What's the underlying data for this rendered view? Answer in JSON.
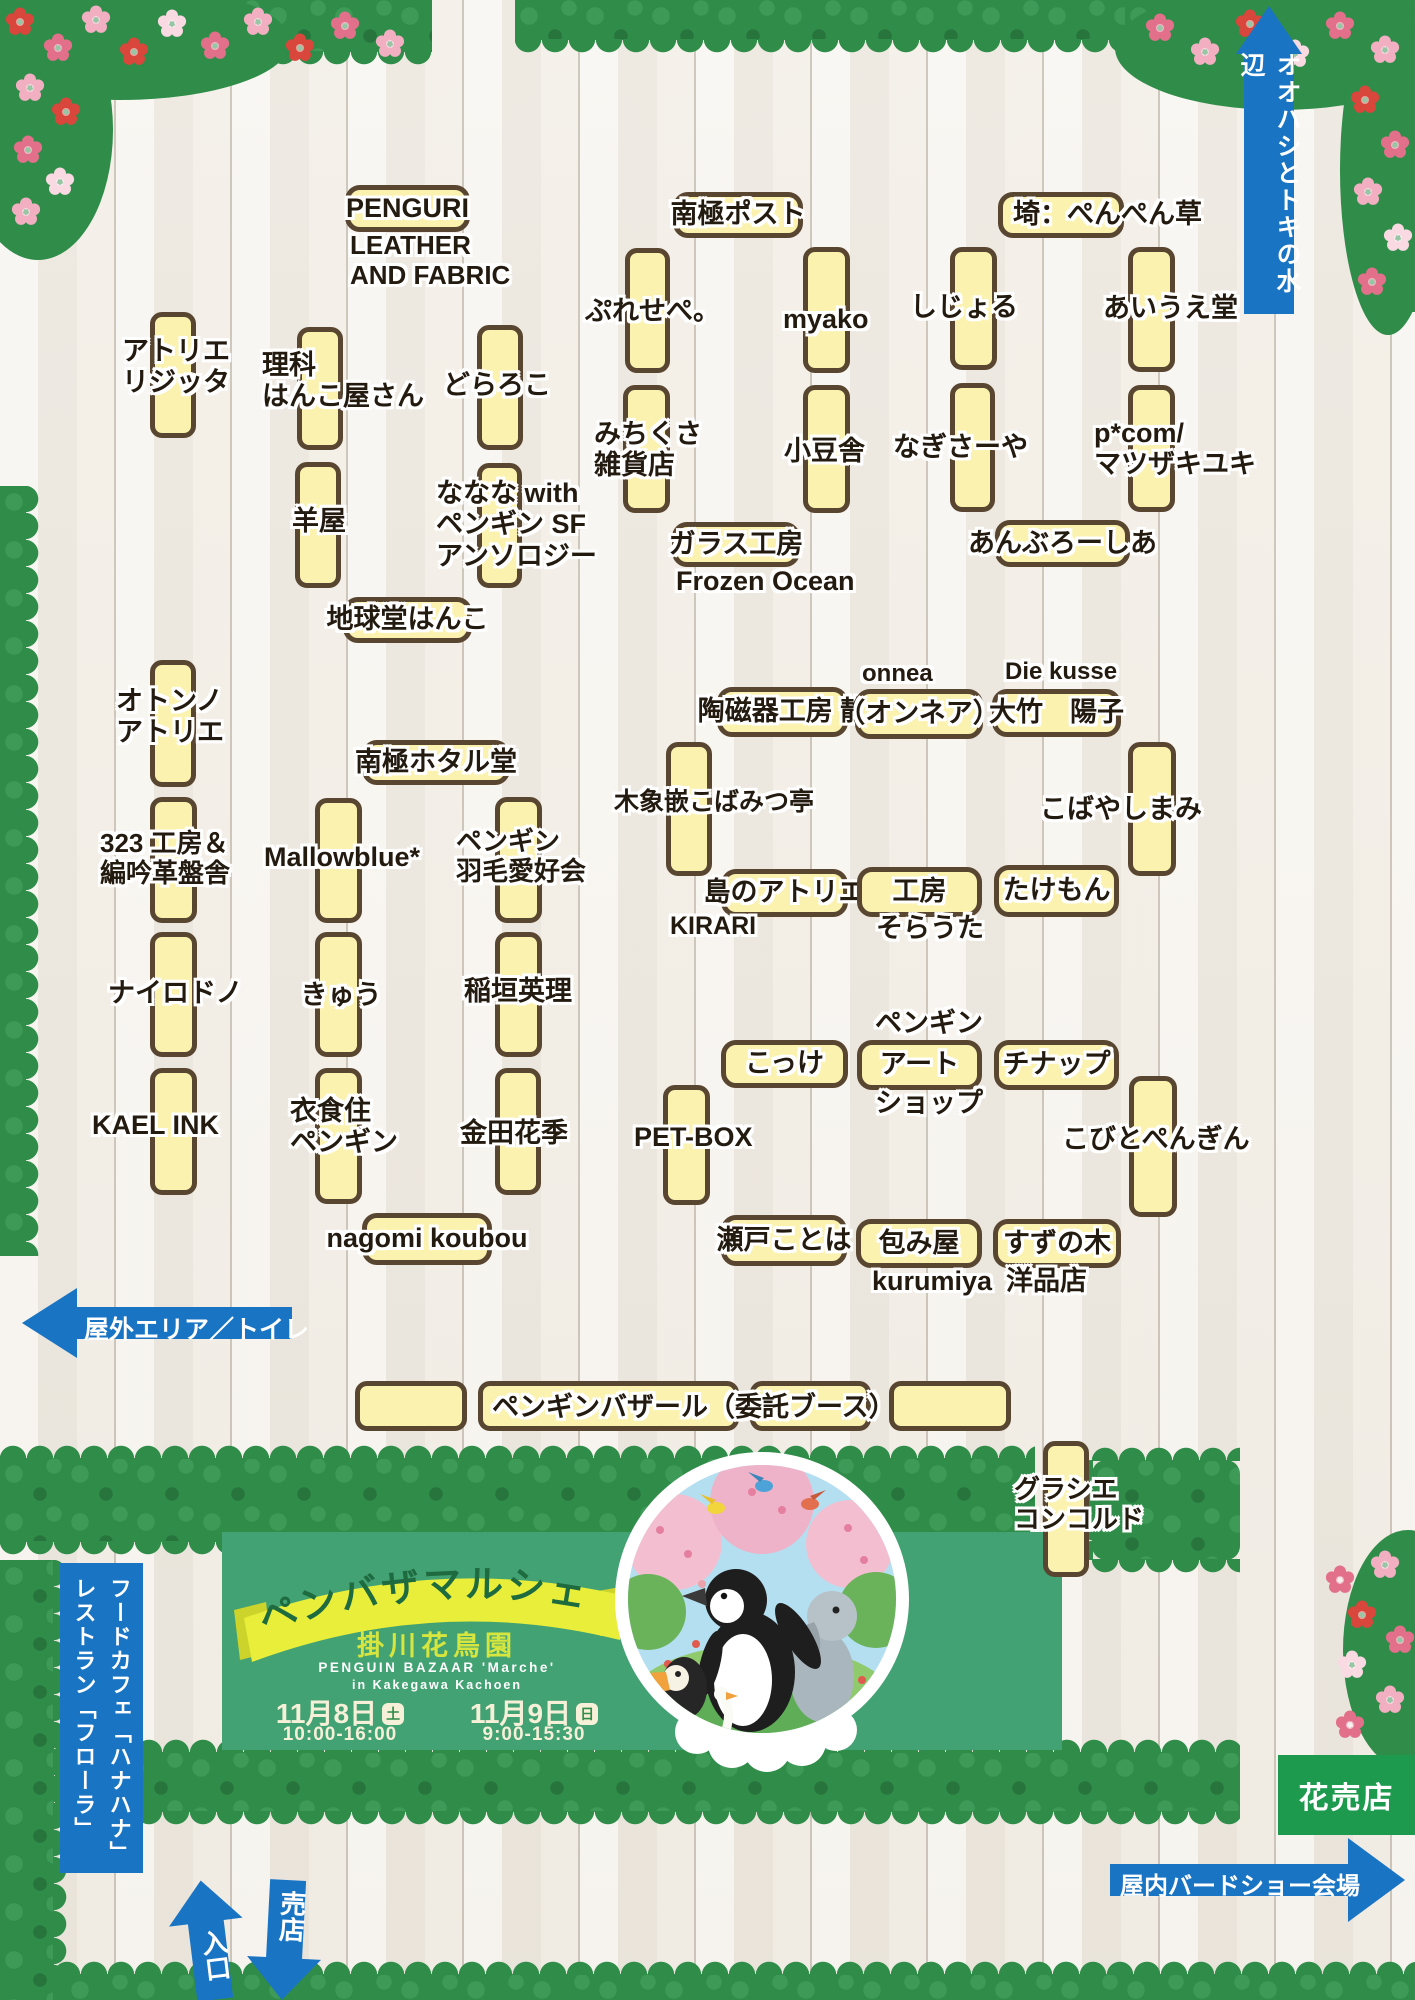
{
  "arrows": {
    "top_right": "オオハシとトキの水辺",
    "outdoor": "屋外エリア／トイレ",
    "indoor_birdshow": "屋内バードショー会場",
    "entrance": "入口",
    "shop": "売店"
  },
  "signs": {
    "restaurant_line1": "レストラン「フローラ」",
    "restaurant_line2": "フードカフェ「ハナハナ」",
    "flower_shop": "花売店"
  },
  "banner": {
    "title": "ペンバザマルシェ",
    "venue": "掛川花鳥園",
    "sub1": "PENGUIN BAZAAR 'Marche'",
    "sub2": "in Kakegawa Kachoen",
    "date1": "11月8日",
    "day1": "土",
    "time1": "10:00-16:00",
    "date2": "11月9日",
    "day2": "日",
    "time2": "9:00-15:30"
  },
  "colors": {
    "booth_fill": "#FAF2AE",
    "booth_border": "#594631",
    "signage_blue": "#1A74C4",
    "banner_green": "#43A273",
    "hedge_green": "#2F8C49",
    "ribbon_yellow": "#E9EE3A",
    "ribbon_text_green": "#1E6B40",
    "flower_shop_green": "#1D9A4E"
  },
  "booths": [
    [
      150,
      312,
      46,
      126
    ],
    [
      297,
      327,
      46,
      123
    ],
    [
      295,
      462,
      46,
      126
    ],
    [
      477,
      325,
      46,
      125
    ],
    [
      477,
      463,
      45,
      125
    ],
    [
      625,
      248,
      45,
      125
    ],
    [
      623,
      385,
      47,
      128
    ],
    [
      803,
      247,
      47,
      126
    ],
    [
      803,
      385,
      47,
      128
    ],
    [
      950,
      247,
      47,
      123
    ],
    [
      950,
      383,
      45,
      129
    ],
    [
      1128,
      247,
      47,
      125
    ],
    [
      1128,
      385,
      47,
      127
    ],
    [
      150,
      660,
      46,
      127
    ],
    [
      150,
      797,
      47,
      126
    ],
    [
      150,
      932,
      47,
      125
    ],
    [
      150,
      1068,
      47,
      127
    ],
    [
      315,
      798,
      47,
      125
    ],
    [
      315,
      932,
      47,
      125
    ],
    [
      315,
      1068,
      47,
      136
    ],
    [
      495,
      797,
      47,
      126
    ],
    [
      495,
      932,
      47,
      125
    ],
    [
      495,
      1068,
      46,
      127
    ],
    [
      666,
      742,
      46,
      134
    ],
    [
      1128,
      742,
      48,
      134
    ],
    [
      663,
      1085,
      47,
      120
    ],
    [
      1129,
      1076,
      48,
      141
    ],
    [
      1043,
      1441,
      46,
      136
    ],
    [
      355,
      1381,
      112,
      50
    ],
    [
      478,
      1381,
      261,
      50
    ],
    [
      750,
      1381,
      121,
      50
    ],
    [
      889,
      1381,
      122,
      50
    ]
  ],
  "pills": [
    {
      "t": "PENGURI",
      "x": 345,
      "y": 185,
      "w": 125,
      "h": 47
    },
    {
      "t": "南極ポスト",
      "x": 673,
      "y": 192,
      "w": 130,
      "h": 46
    },
    {
      "t": "埼：ぺんぺん草",
      "x": 998,
      "y": 192,
      "w": 126,
      "h": 46,
      "al": true
    },
    {
      "t": "ガラス工房",
      "x": 672,
      "y": 522,
      "w": 128,
      "h": 45
    },
    {
      "t": "あんぶろーしあ",
      "x": 995,
      "y": 520,
      "w": 135,
      "h": 47
    },
    {
      "t": "地球堂はんこ",
      "x": 343,
      "y": 597,
      "w": 129,
      "h": 46
    },
    {
      "t": "南極ホタル堂",
      "x": 362,
      "y": 740,
      "w": 148,
      "h": 45
    },
    {
      "t": "陶磁器工房 静",
      "x": 717,
      "y": 687,
      "w": 131,
      "h": 50
    },
    {
      "t": "（オンネア）",
      "x": 855,
      "y": 689,
      "w": 128,
      "h": 50
    },
    {
      "t": "大竹　陽子",
      "x": 992,
      "y": 689,
      "w": 129,
      "h": 48
    },
    {
      "t": "島のアトリエ",
      "x": 721,
      "y": 869,
      "w": 127,
      "h": 48
    },
    {
      "t": "工房",
      "x": 857,
      "y": 867,
      "w": 125,
      "h": 50
    },
    {
      "t": "たけもん",
      "x": 994,
      "y": 865,
      "w": 125,
      "h": 52
    },
    {
      "t": "こっけ",
      "x": 721,
      "y": 1040,
      "w": 127,
      "h": 48
    },
    {
      "t": "アート",
      "x": 857,
      "y": 1040,
      "w": 125,
      "h": 50
    },
    {
      "t": "チナップ",
      "x": 994,
      "y": 1040,
      "w": 125,
      "h": 50
    },
    {
      "t": "nagomi koubou",
      "x": 362,
      "y": 1213,
      "w": 130,
      "h": 52
    },
    {
      "t": "瀬戸ことは",
      "x": 721,
      "y": 1215,
      "w": 126,
      "h": 51
    },
    {
      "t": "包み屋",
      "x": 856,
      "y": 1219,
      "w": 126,
      "h": 49
    },
    {
      "t": "すずの木",
      "x": 993,
      "y": 1219,
      "w": 128,
      "h": 49
    }
  ],
  "labels": [
    {
      "t": "LEATHER\nAND FABRIC",
      "x": 350,
      "y": 230,
      "w": 170,
      "s": 26,
      "a": "left"
    },
    {
      "t": "アトリエ\nリジッタ",
      "x": 122,
      "y": 336,
      "w": 118,
      "s": 27,
      "a": "left"
    },
    {
      "t": "理科\nはんこ屋さん",
      "x": 262,
      "y": 350,
      "w": 180,
      "s": 27,
      "a": "left"
    },
    {
      "t": "どらろこ",
      "x": 443,
      "y": 370,
      "s": 27,
      "a": "left",
      "nw": true
    },
    {
      "t": "羊屋",
      "x": 288,
      "y": 506,
      "w": 62,
      "s": 27
    },
    {
      "t": "ななな with\nペンギン SF\nアンソロジー",
      "x": 436,
      "y": 478,
      "w": 175,
      "s": 27,
      "a": "left"
    },
    {
      "t": "ぷれせぺ。",
      "x": 585,
      "y": 296,
      "s": 27,
      "a": "left",
      "nw": true
    },
    {
      "t": "myako",
      "x": 783,
      "y": 304,
      "s": 27,
      "a": "left",
      "nw": true
    },
    {
      "t": "しじょる",
      "x": 910,
      "y": 292,
      "s": 27,
      "a": "left",
      "nw": true
    },
    {
      "t": "あいうえ堂",
      "x": 1103,
      "y": 293,
      "s": 27,
      "a": "left",
      "nw": true
    },
    {
      "t": "みちくさ\n雑貨店",
      "x": 594,
      "y": 419,
      "w": 112,
      "s": 27,
      "a": "left"
    },
    {
      "t": "小豆舎",
      "x": 784,
      "y": 436,
      "s": 27,
      "a": "left",
      "nw": true
    },
    {
      "t": "なぎさーや",
      "x": 893,
      "y": 432,
      "s": 27,
      "a": "left",
      "nw": true
    },
    {
      "t": "p*com/\nマツザキユキ",
      "x": 1094,
      "y": 418,
      "w": 170,
      "s": 27,
      "a": "left"
    },
    {
      "t": "Frozen Ocean",
      "x": 676,
      "y": 566,
      "s": 27,
      "a": "left",
      "nw": true
    },
    {
      "t": "木象嵌こばみつ亭",
      "x": 614,
      "y": 788,
      "s": 25,
      "a": "left",
      "nw": true
    },
    {
      "t": "こばやしまみ",
      "x": 1040,
      "y": 794,
      "s": 27,
      "a": "left",
      "nw": true
    },
    {
      "t": "onnea",
      "x": 862,
      "y": 660,
      "s": 24,
      "a": "left",
      "nw": true
    },
    {
      "t": "Die kusse",
      "x": 1005,
      "y": 658,
      "s": 24,
      "a": "left",
      "nw": true
    },
    {
      "t": "KIRARI",
      "x": 670,
      "y": 912,
      "s": 25,
      "a": "left",
      "nw": true
    },
    {
      "t": "そらうた",
      "x": 876,
      "y": 913,
      "w": 108,
      "s": 27
    },
    {
      "t": "ペンギン",
      "x": 874,
      "y": 1008,
      "w": 110,
      "s": 27
    },
    {
      "t": "ショップ",
      "x": 874,
      "y": 1088,
      "w": 110,
      "s": 27
    },
    {
      "t": "kurumiya",
      "x": 872,
      "y": 1266,
      "s": 27,
      "a": "left",
      "nw": true
    },
    {
      "t": "洋品店",
      "x": 1006,
      "y": 1266,
      "s": 27,
      "a": "left",
      "nw": true
    },
    {
      "t": "オトンノ\nアトリエ",
      "x": 116,
      "y": 686,
      "w": 118,
      "s": 27,
      "a": "left"
    },
    {
      "t": "323 工房＆\n編吟革盤舎",
      "x": 100,
      "y": 828,
      "w": 150,
      "s": 26,
      "a": "left"
    },
    {
      "t": "ナイロドノ",
      "x": 108,
      "y": 978,
      "s": 27,
      "a": "left",
      "nw": true
    },
    {
      "t": "KAEL INK",
      "x": 92,
      "y": 1110,
      "s": 27,
      "a": "left",
      "nw": true
    },
    {
      "t": "Mallowblue*",
      "x": 264,
      "y": 842,
      "s": 27,
      "a": "left",
      "nw": true
    },
    {
      "t": "きゅう",
      "x": 298,
      "y": 980,
      "w": 86,
      "s": 27
    },
    {
      "t": "衣食住\nペンギン",
      "x": 290,
      "y": 1096,
      "w": 120,
      "s": 27,
      "a": "left"
    },
    {
      "t": "ペンギン\n羽毛愛好会",
      "x": 456,
      "y": 826,
      "w": 142,
      "s": 26,
      "a": "left"
    },
    {
      "t": "稲垣英理",
      "x": 464,
      "y": 976,
      "s": 27,
      "a": "left",
      "nw": true
    },
    {
      "t": "金田花季",
      "x": 460,
      "y": 1118,
      "s": 27,
      "a": "left",
      "nw": true
    },
    {
      "t": "PET-BOX",
      "x": 634,
      "y": 1122,
      "s": 27,
      "a": "left",
      "nw": true
    },
    {
      "t": "こびとぺんぎん",
      "x": 1062,
      "y": 1124,
      "s": 27,
      "a": "left",
      "nw": true
    },
    {
      "t": "グラシエ\nコンコルド",
      "x": 1014,
      "y": 1474,
      "w": 150,
      "s": 26,
      "a": "left"
    },
    {
      "t": "ペンギンバザール（委託ブース）",
      "x": 492,
      "y": 1392,
      "s": 27,
      "a": "left",
      "nw": true
    }
  ]
}
